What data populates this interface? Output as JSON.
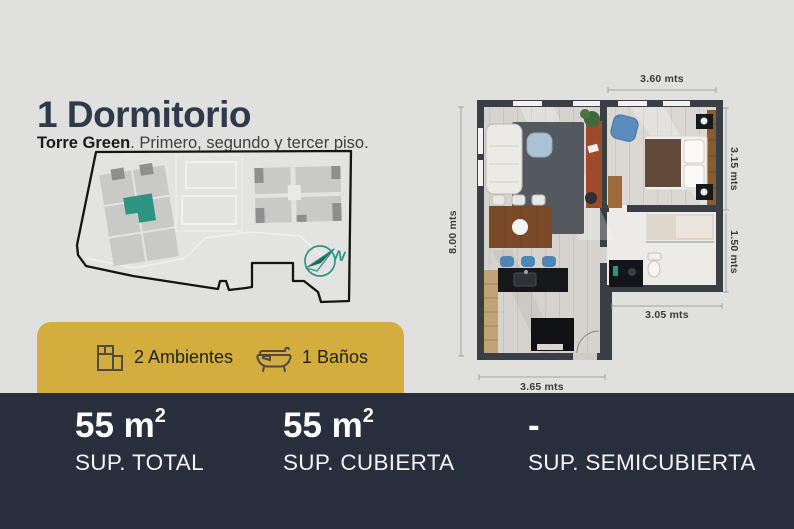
{
  "header": {
    "title": "1 Dormitorio",
    "subtitle_bold": "Torre Green",
    "subtitle_rest": ". Primero, segundo y tercer piso."
  },
  "site_plan": {
    "compass_letter": "N",
    "highlight_color": "#2e9482"
  },
  "features": {
    "items": [
      {
        "icon": "floorplan-rooms-icon",
        "label": "2 Ambientes"
      },
      {
        "icon": "bathtub-icon",
        "label": "1 Baños"
      }
    ]
  },
  "floor_plan": {
    "dimensions": {
      "top": "3.60 mts",
      "left": "8.00 mts",
      "right_upper": "3.15 mts",
      "right_lower": "1.50 mts",
      "inner_bottom": "3.05 mts",
      "bottom": "3.65 mts"
    }
  },
  "summary": {
    "columns": [
      {
        "value": "55 m",
        "sup": "2",
        "label": "SUP. TOTAL"
      },
      {
        "value": "55 m",
        "sup": "2",
        "label": "SUP. CUBIERTA"
      },
      {
        "value": "-",
        "sup": "",
        "label": "SUP. SEMICUBIERTA"
      }
    ]
  },
  "colors": {
    "accent_gold": "#d3ae3e",
    "accent_teal": "#2e9482",
    "panel_navy": "#272e3c"
  }
}
